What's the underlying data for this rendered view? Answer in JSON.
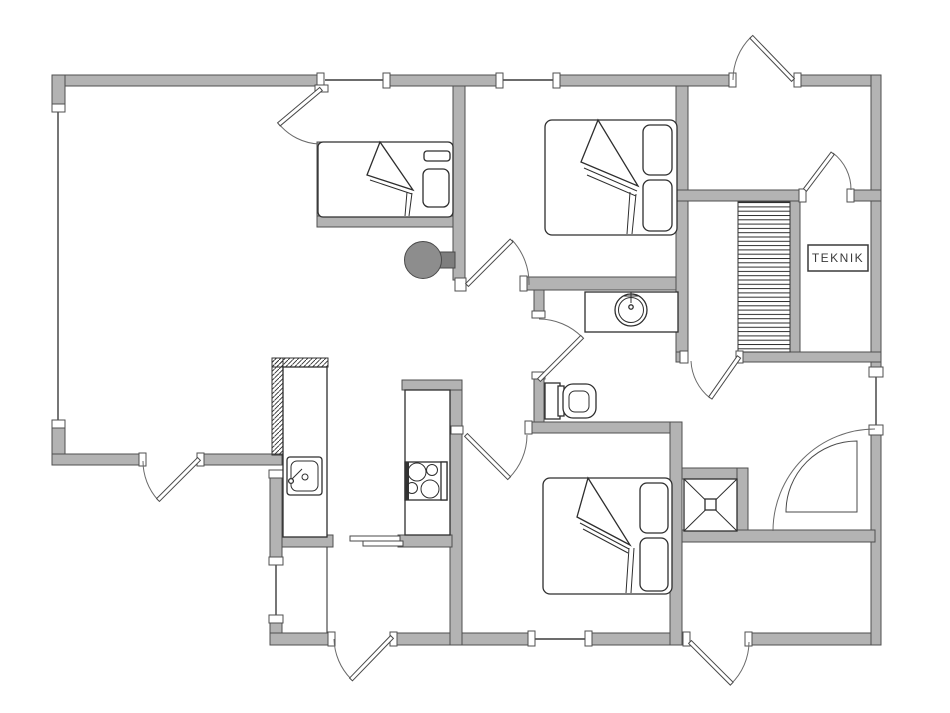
{
  "plan": {
    "teknik_label": "TEKNIK",
    "colors": {
      "background": "#ffffff",
      "wall_fill": "#b3b3b3",
      "wall_stroke": "#4f4f4f",
      "furniture_line": "#2e2e2e",
      "wood_stove_fill": "#8d8d8d"
    },
    "fixtures": [
      "double-bed",
      "double-bed",
      "single-bed",
      "toilet",
      "washbasin",
      "kitchen-sink",
      "cooktop",
      "wood-stove",
      "corner-shower",
      "stairs",
      "sliding-door"
    ],
    "door_count": 10,
    "window_count": 6
  }
}
